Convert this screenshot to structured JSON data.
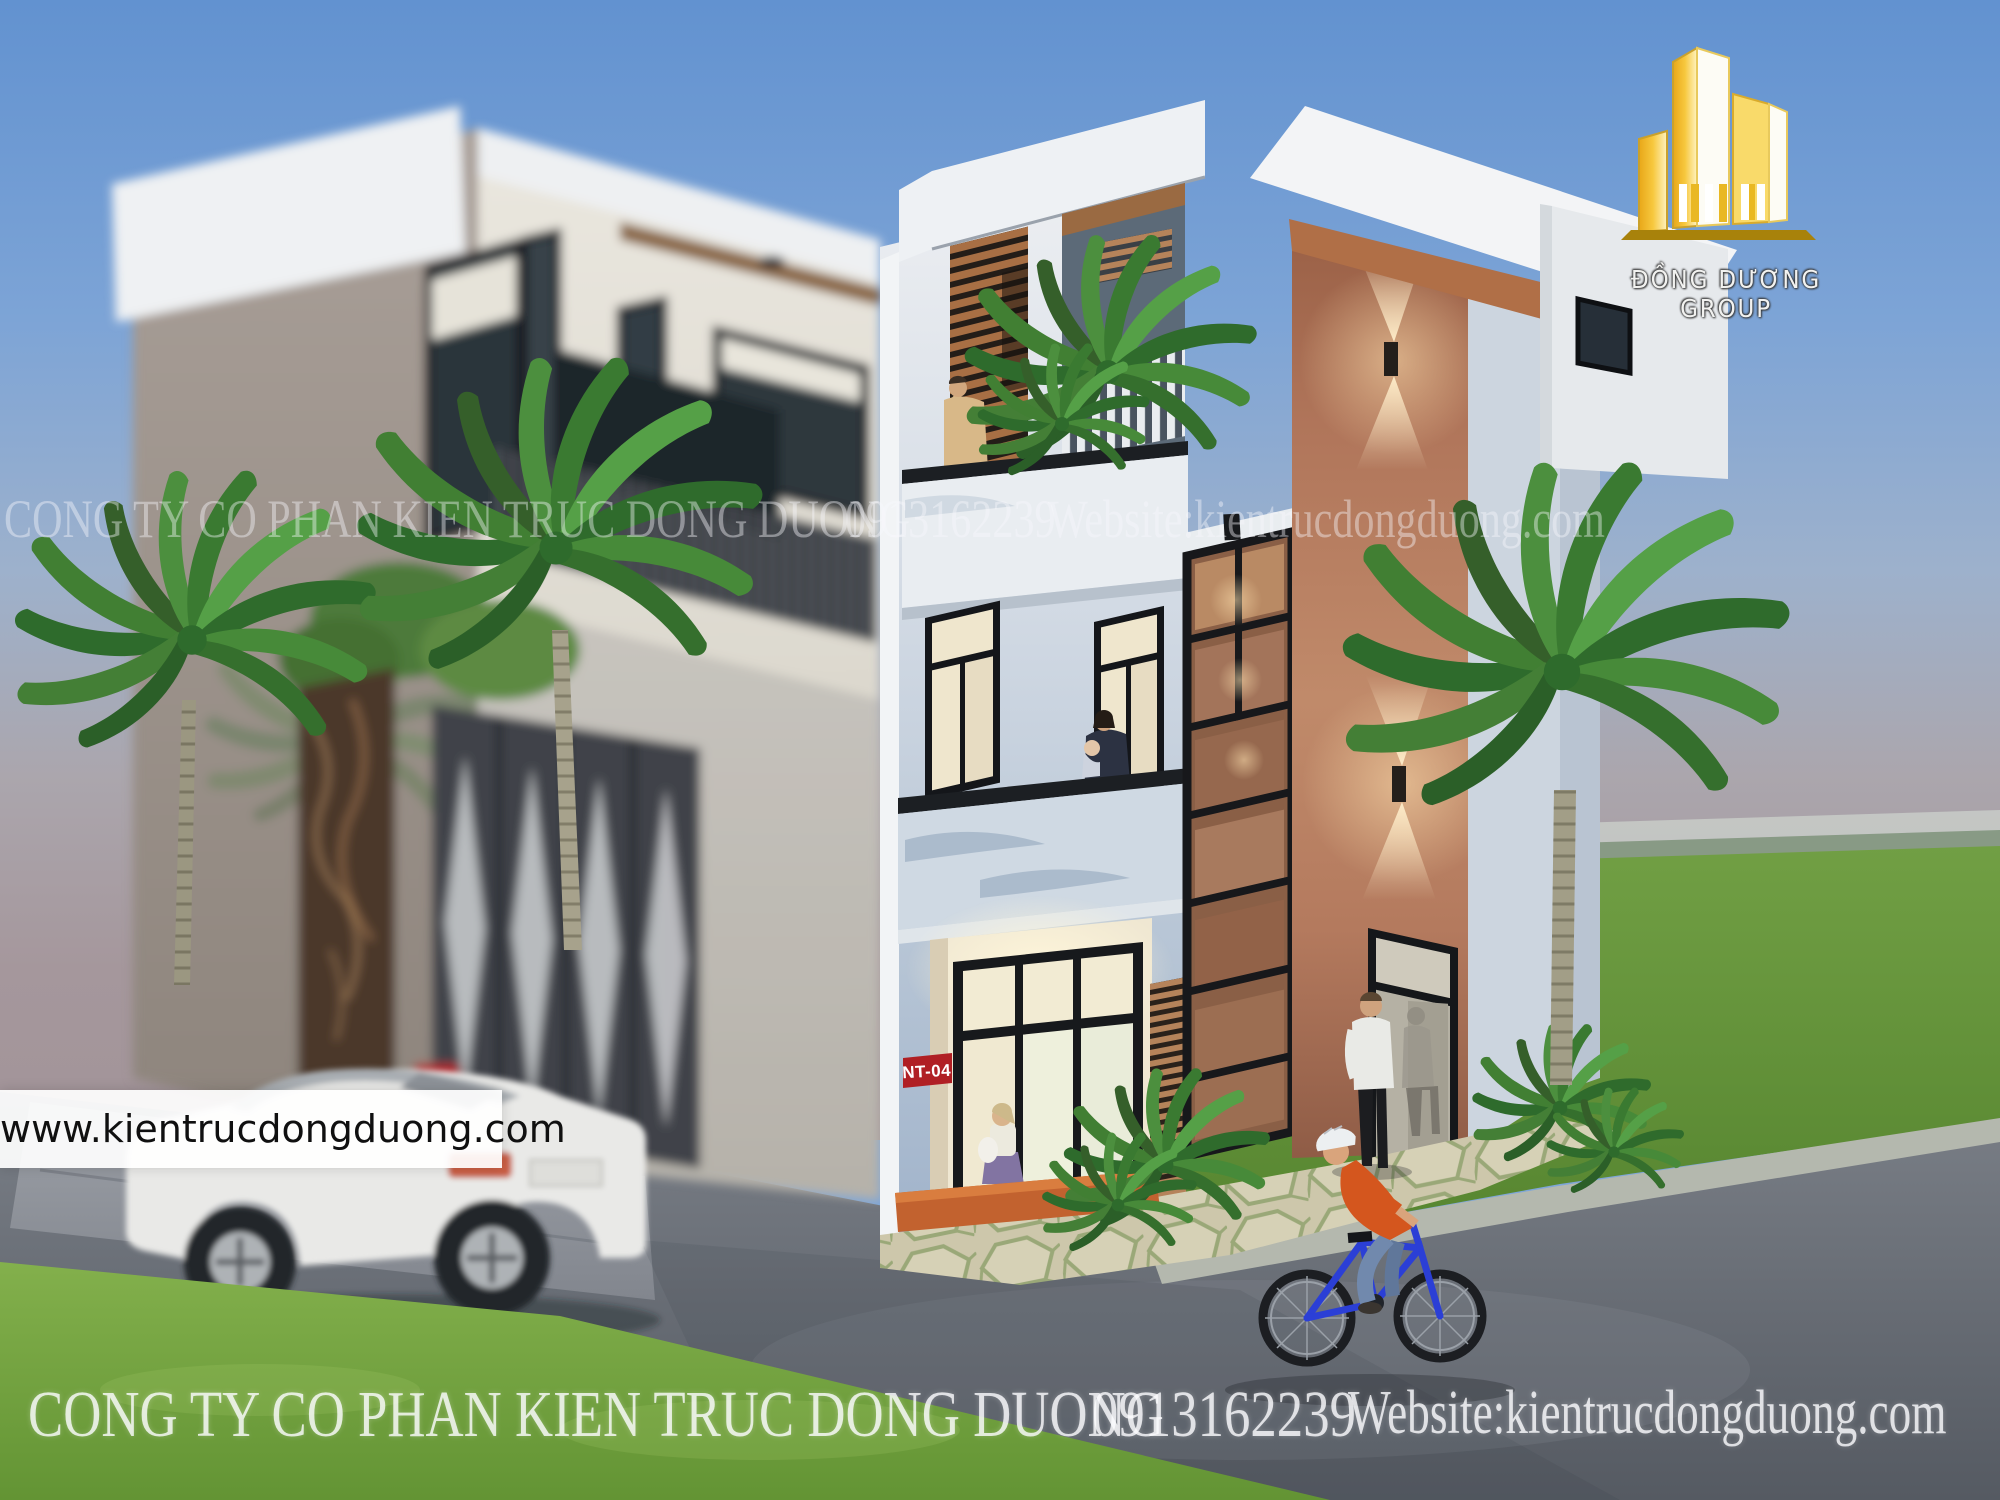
{
  "branding": {
    "group_name": "ĐỒNG DƯƠNG GROUP",
    "logo_icon": "gold-buildings-icon"
  },
  "watermark_center": {
    "company": "CONG TY CO PHAN KIEN TRUC DONG DUONG",
    "phone": "0913162239",
    "website": "Website:kientrucdongduong.com"
  },
  "watermark_bottom": {
    "company": "CONG TY CO PHAN KIEN TRUC DONG DUONG",
    "phone": "0913162239",
    "website": "Website:kientrucdongduong.com"
  },
  "url_bar": {
    "text": "www.kientrucdongduong.com"
  },
  "signs": {
    "unit_label": "NT-04"
  },
  "scene": {
    "type": "architectural-exterior-render",
    "subject": "modern-three-storey-townhouse",
    "objects": [
      "white-sedan-car",
      "cyclist-on-blue-bicycle",
      "palm-trees",
      "pedestrians",
      "garage-gate",
      "balconies",
      "roof-terrace",
      "wall-lights",
      "stone-walkway"
    ]
  },
  "colors": {
    "sky_top": "#6292d0",
    "haze": "#a29499",
    "accent_peach": "#c08a6a",
    "wood_louver": "#a86f44",
    "sign_red": "#b01f24",
    "interior_warm": "#f3ecd6",
    "grass": "#74a341",
    "road": "#5d6269",
    "logo_gold": "#f7c83e"
  }
}
